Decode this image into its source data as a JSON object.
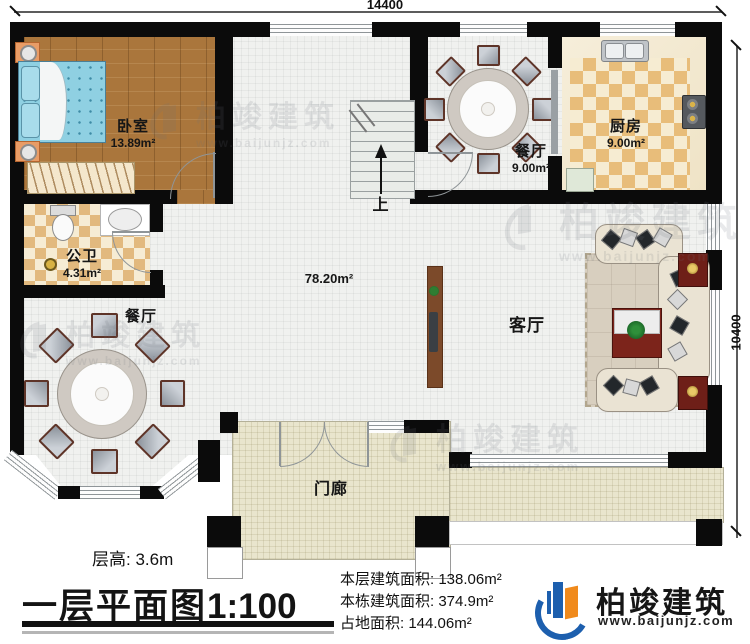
{
  "dimensions": {
    "width": "14400",
    "height": "10400"
  },
  "rooms": {
    "bedroom": {
      "name": "卧室",
      "area": "13.89m²"
    },
    "bathroom": {
      "name": "公卫",
      "area": "4.31m²"
    },
    "dining_top": {
      "name": "餐厅",
      "area": "9.00m²"
    },
    "kitchen": {
      "name": "厨房",
      "area": "9.00m²"
    },
    "dining_bottom": {
      "name": "餐厅"
    },
    "living": {
      "name": "客厅"
    },
    "hall": {
      "area": "78.20m²"
    },
    "stairs": {
      "label": "上"
    },
    "porch": {
      "name": "门廊"
    }
  },
  "footer": {
    "floor_height": "层高: 3.6m",
    "title": "一层平面图",
    "scale": "1:100",
    "stats": [
      {
        "label": "本层建筑面积:",
        "value": "138.06m²"
      },
      {
        "label": "本栋建筑面积:",
        "value": "374.9m²"
      },
      {
        "label": "占地面积:",
        "value": "144.06m²"
      }
    ]
  },
  "brand": {
    "name": "柏竣建筑",
    "url": "www.baijunjz.com"
  },
  "watermark": {
    "name": "柏竣建筑",
    "url": "www.baijunjz.com"
  },
  "colors": {
    "brand_blue": "#1d5fae",
    "brand_orange": "#f08a1c",
    "wall": "#0b0b0b"
  }
}
